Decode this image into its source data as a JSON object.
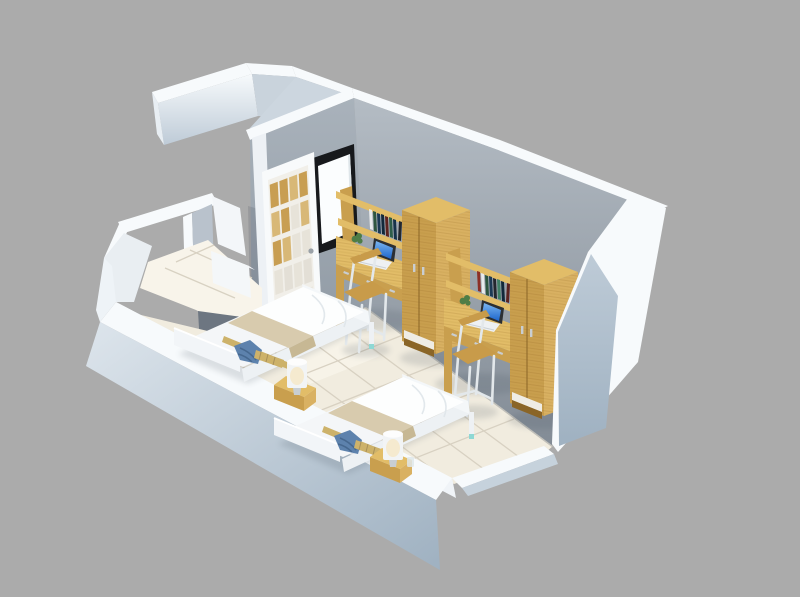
{
  "scene": {
    "description": "3D isometric cutaway render of a twin dormitory bedroom floor plan with entry hall, two single beds, two study desks with laptops and bookshelves, two wardrobes, a white french door and a black-framed window",
    "room_type": "twin dorm bedroom",
    "objects": {
      "background": "plain gray backdrop",
      "wing_walls": "exterior corridor walls (top left)",
      "wall_ne": "rear wall behind desks",
      "wall_door": "side wall with french door and window",
      "french_door": "white 20-pane french door",
      "window": "black framed bright window",
      "entry": "entry hall with tiled floor and partition",
      "floor": "cream ceramic tile floor",
      "desk_1": "wooden study desk with hutch, books and laptop",
      "desk_2": "wooden study desk with hutch, books and laptop",
      "wardrobe_1": "two-door wooden wardrobe",
      "wardrobe_2": "two-door wooden wardrobe",
      "chair_1": "white chair with wooden seat",
      "chair_2": "white chair with wooden seat",
      "bed_1": "single bed with white duvet and beige runner",
      "bed_2": "single bed with white duvet and beige runner",
      "nightstand_1": "wooden bedside cabinet",
      "nightstand_2": "wooden bedside cabinet",
      "lamp_1": "white cylindrical table lamp",
      "lamp_2": "white cylindrical table lamp",
      "plant_1": "small potted plant",
      "plant_2": "small potted plant",
      "cut_walls": "low cutaway front walls"
    }
  },
  "palette": {
    "bg": "#ababab",
    "white_top": "#f7fafc",
    "inner_white": "#f0f4f8",
    "jamb_white": "#edf1f5",
    "wall_ne_top": "#b4bcc4",
    "wall_ne_bottom": "#838c96",
    "wall_door_top": "#a9b2bb",
    "wall_door_bottom": "#8f99a3",
    "outer_light": "#dde5ec",
    "outer_mid": "#becbd7",
    "outer_dark": "#9fb1c1",
    "partition_dark": "#6d7681",
    "slab_gray": "#b9c2cc",
    "window_frame": "#17191c",
    "window_glass": "#fbfdfe",
    "door_white": "#f8fafb",
    "pane_wood": "#c89e52",
    "pane_wood_light": "#d8b877",
    "pane_light": "#e7e3d9",
    "floor": "#f1ecdf",
    "floor_light": "#f8f4ea",
    "grout": "#d8d1c2",
    "wood_front": "#c99f4e",
    "wood_side": "#d9b162",
    "wood_top": "#e2bd68",
    "wood_dark": "#a87f35",
    "wood_plinth": "#8a6527",
    "laptop_rim": "#2b2f34",
    "laptop_blue1": "#1d66cc",
    "laptop_blue2": "#7ab5f0",
    "laptop_body": "#eef1f3",
    "chair_frame": "#e3e8eb",
    "seat_wood": "#c89b4a",
    "duvet": "#fdfefe",
    "duvet_shadow": "#dfe5ea",
    "mattress": "#f4f6f8",
    "blanket": "#d8cbae",
    "blanket_dark": "#c7b894",
    "headboard": "#f2f5f8",
    "pillow_blue": "#5d82ad",
    "pillow_blue_dark": "#46688f",
    "bamboo": "#cdb26a",
    "lamp_shade": "#f2f4f5",
    "lamp_glow": "#f6e8c8",
    "teal": "#8ed8d4",
    "metal": "#c9ced2",
    "plant_green": "#4e7d46"
  },
  "books": {
    "shelf1": [
      "#e9ebec",
      "#2e5640",
      "#1c3a55",
      "#11283a",
      "#5d2420",
      "#2e5e4a",
      "#16324a",
      "#23272e"
    ],
    "shelf2": [
      "#8c2f26",
      "#e9ebec",
      "#2e5640",
      "#1c3a55",
      "#23272e",
      "#3f7f66",
      "#11283a",
      "#5d2420"
    ]
  }
}
